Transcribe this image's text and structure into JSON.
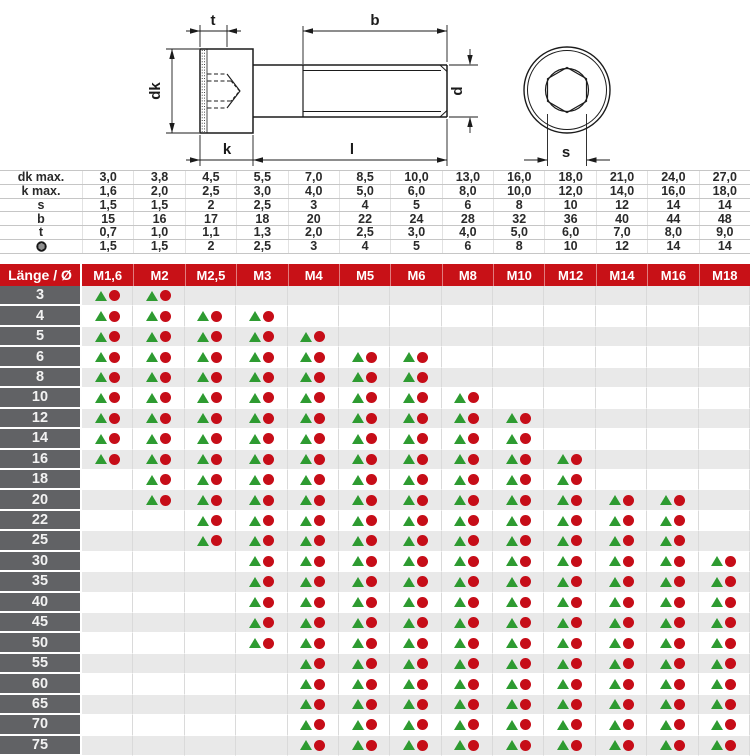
{
  "drawing": {
    "labels": {
      "t": "t",
      "b": "b",
      "dk": "dk",
      "d": "d",
      "k": "k",
      "l": "l",
      "s": "s"
    }
  },
  "dimensions_table": {
    "rows": [
      {
        "label": "dk max.",
        "icon": null,
        "values": [
          "3,0",
          "3,8",
          "4,5",
          "5,5",
          "7,0",
          "8,5",
          "10,0",
          "13,0",
          "16,0",
          "18,0",
          "21,0",
          "24,0",
          "27,0"
        ]
      },
      {
        "label": "k max.",
        "icon": null,
        "values": [
          "1,6",
          "2,0",
          "2,5",
          "3,0",
          "4,0",
          "5,0",
          "6,0",
          "8,0",
          "10,0",
          "12,0",
          "14,0",
          "16,0",
          "18,0"
        ]
      },
      {
        "label": "s",
        "icon": null,
        "values": [
          "1,5",
          "1,5",
          "2",
          "2,5",
          "3",
          "4",
          "5",
          "6",
          "8",
          "10",
          "12",
          "14",
          "14"
        ]
      },
      {
        "label": "b",
        "icon": null,
        "values": [
          "15",
          "16",
          "17",
          "18",
          "20",
          "22",
          "24",
          "28",
          "32",
          "36",
          "40",
          "44",
          "48"
        ]
      },
      {
        "label": "t",
        "icon": null,
        "values": [
          "0,7",
          "1,0",
          "1,1",
          "1,3",
          "2,0",
          "2,5",
          "3,0",
          "4,0",
          "5,0",
          "6,0",
          "7,0",
          "8,0",
          "9,0"
        ]
      },
      {
        "label": "",
        "icon": "hex-socket",
        "values": [
          "1,5",
          "1,5",
          "2",
          "2,5",
          "3",
          "4",
          "5",
          "6",
          "8",
          "10",
          "12",
          "14",
          "14"
        ]
      }
    ]
  },
  "matrix": {
    "corner_label": "Länge / Ø",
    "columns": [
      "M1,6",
      "M2",
      "M2,5",
      "M3",
      "M4",
      "M5",
      "M6",
      "M8",
      "M10",
      "M12",
      "M14",
      "M16",
      "M18"
    ],
    "rows": [
      {
        "length": "3",
        "cells": [
          1,
          1,
          0,
          0,
          0,
          0,
          0,
          0,
          0,
          0,
          0,
          0,
          0
        ]
      },
      {
        "length": "4",
        "cells": [
          1,
          1,
          1,
          1,
          0,
          0,
          0,
          0,
          0,
          0,
          0,
          0,
          0
        ]
      },
      {
        "length": "5",
        "cells": [
          1,
          1,
          1,
          1,
          1,
          0,
          0,
          0,
          0,
          0,
          0,
          0,
          0
        ]
      },
      {
        "length": "6",
        "cells": [
          1,
          1,
          1,
          1,
          1,
          1,
          1,
          0,
          0,
          0,
          0,
          0,
          0
        ]
      },
      {
        "length": "8",
        "cells": [
          1,
          1,
          1,
          1,
          1,
          1,
          1,
          0,
          0,
          0,
          0,
          0,
          0
        ]
      },
      {
        "length": "10",
        "cells": [
          1,
          1,
          1,
          1,
          1,
          1,
          1,
          1,
          0,
          0,
          0,
          0,
          0
        ]
      },
      {
        "length": "12",
        "cells": [
          1,
          1,
          1,
          1,
          1,
          1,
          1,
          1,
          1,
          0,
          0,
          0,
          0
        ]
      },
      {
        "length": "14",
        "cells": [
          1,
          1,
          1,
          1,
          1,
          1,
          1,
          1,
          1,
          0,
          0,
          0,
          0
        ]
      },
      {
        "length": "16",
        "cells": [
          1,
          1,
          1,
          1,
          1,
          1,
          1,
          1,
          1,
          1,
          0,
          0,
          0
        ]
      },
      {
        "length": "18",
        "cells": [
          0,
          1,
          1,
          1,
          1,
          1,
          1,
          1,
          1,
          1,
          0,
          0,
          0
        ]
      },
      {
        "length": "20",
        "cells": [
          0,
          1,
          1,
          1,
          1,
          1,
          1,
          1,
          1,
          1,
          1,
          1,
          0
        ]
      },
      {
        "length": "22",
        "cells": [
          0,
          0,
          1,
          1,
          1,
          1,
          1,
          1,
          1,
          1,
          1,
          1,
          0
        ]
      },
      {
        "length": "25",
        "cells": [
          0,
          0,
          1,
          1,
          1,
          1,
          1,
          1,
          1,
          1,
          1,
          1,
          0
        ]
      },
      {
        "length": "30",
        "cells": [
          0,
          0,
          0,
          1,
          1,
          1,
          1,
          1,
          1,
          1,
          1,
          1,
          1
        ]
      },
      {
        "length": "35",
        "cells": [
          0,
          0,
          0,
          1,
          1,
          1,
          1,
          1,
          1,
          1,
          1,
          1,
          1
        ]
      },
      {
        "length": "40",
        "cells": [
          0,
          0,
          0,
          1,
          1,
          1,
          1,
          1,
          1,
          1,
          1,
          1,
          1
        ]
      },
      {
        "length": "45",
        "cells": [
          0,
          0,
          0,
          1,
          1,
          1,
          1,
          1,
          1,
          1,
          1,
          1,
          1
        ]
      },
      {
        "length": "50",
        "cells": [
          0,
          0,
          0,
          1,
          1,
          1,
          1,
          1,
          1,
          1,
          1,
          1,
          1
        ]
      },
      {
        "length": "55",
        "cells": [
          0,
          0,
          0,
          0,
          1,
          1,
          1,
          1,
          1,
          1,
          1,
          1,
          1
        ]
      },
      {
        "length": "60",
        "cells": [
          0,
          0,
          0,
          0,
          1,
          1,
          1,
          1,
          1,
          1,
          1,
          1,
          1
        ]
      },
      {
        "length": "65",
        "cells": [
          0,
          0,
          0,
          0,
          1,
          1,
          1,
          1,
          1,
          1,
          1,
          1,
          1
        ]
      },
      {
        "length": "70",
        "cells": [
          0,
          0,
          0,
          0,
          1,
          1,
          1,
          1,
          1,
          1,
          1,
          1,
          1
        ]
      },
      {
        "length": "75",
        "cells": [
          0,
          0,
          0,
          0,
          1,
          1,
          1,
          1,
          1,
          1,
          1,
          1,
          1
        ]
      }
    ]
  },
  "colors": {
    "header_red": "#c81117",
    "row_label_gray": "#616265",
    "row_alt_gray": "#e9e9e9",
    "triangle_green": "#2e9b31",
    "dot_red": "#c60d18"
  }
}
